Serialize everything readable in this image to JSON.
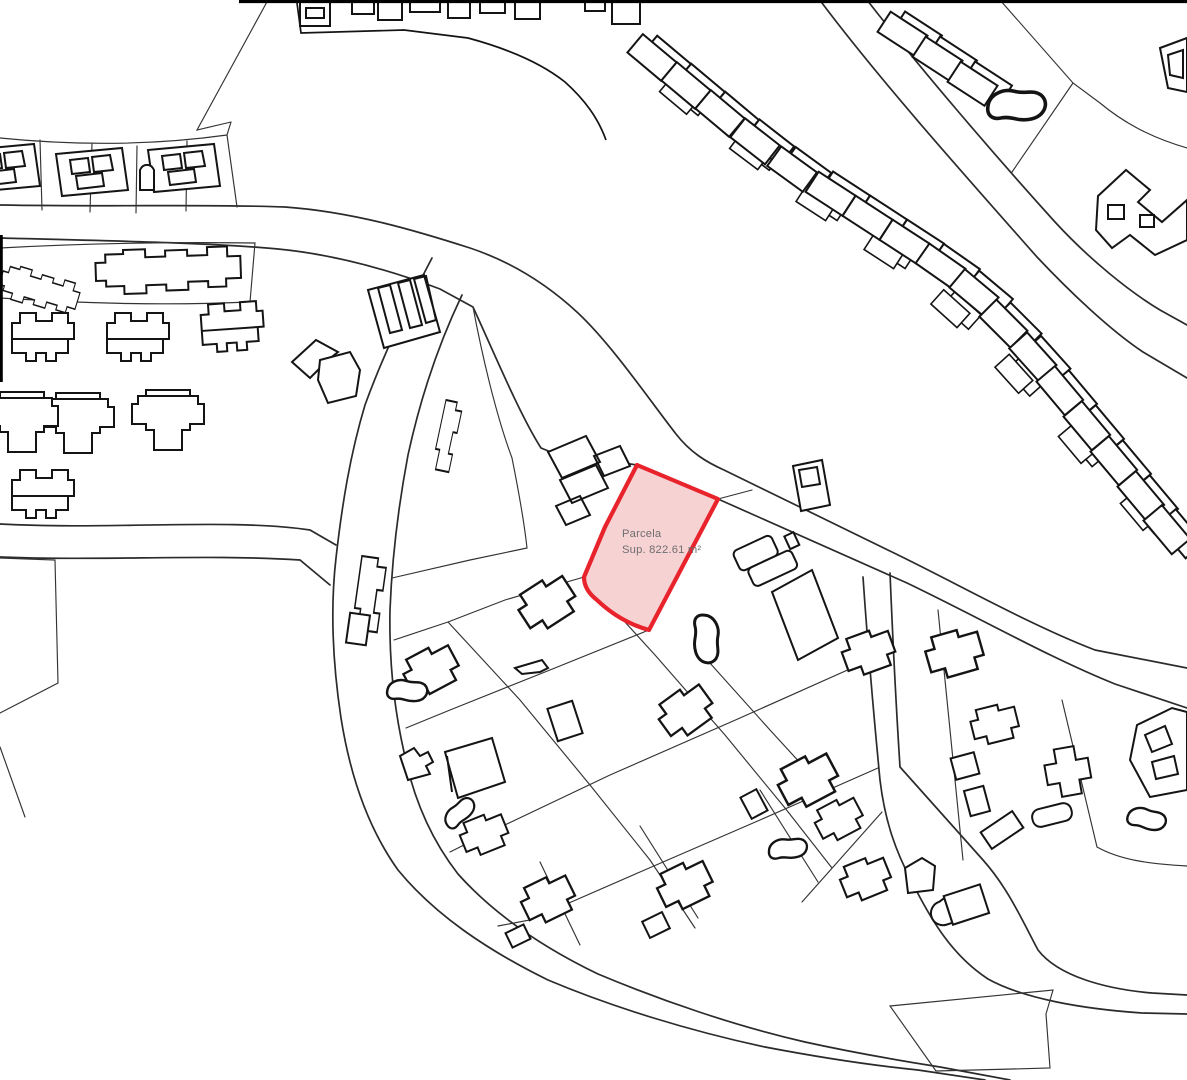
{
  "map": {
    "type": "cadastral-parcel-map",
    "background_color": "#ffffff",
    "line_color": "#2b2b2b",
    "highlighted_parcel": {
      "name_label": "Parcela",
      "area_label": "Sup. 822.61 m²",
      "area_value_m2": 822.61,
      "fill_color": "#f7d2d2",
      "stroke_color": "#e8232b",
      "label_color": "#6d6e71"
    }
  }
}
